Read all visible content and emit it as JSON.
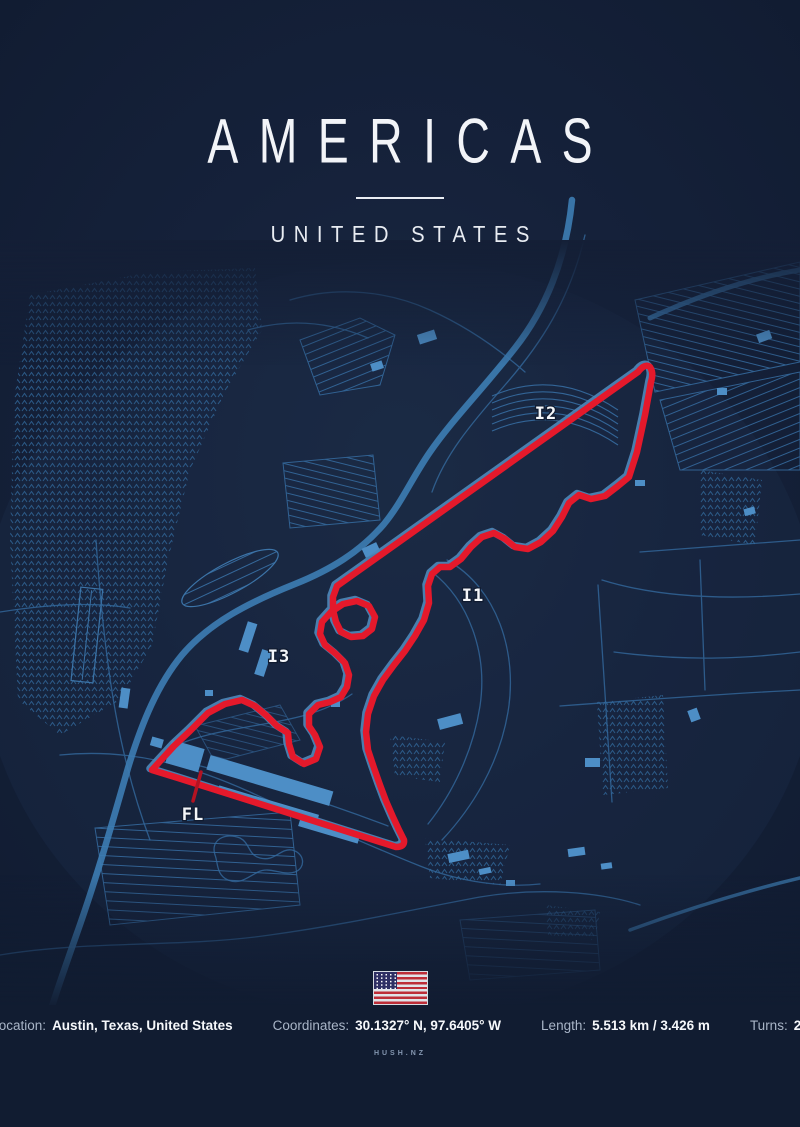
{
  "header": {
    "title": "AMERICAS",
    "subtitle": "UNITED STATES"
  },
  "map": {
    "name": "circuit-of-the-americas-track-map",
    "sector_labels": {
      "i1": "I1",
      "i2": "I2",
      "i3": "I3",
      "fl": "FL"
    }
  },
  "flag": {
    "country": "United States"
  },
  "info": {
    "location": {
      "label": "Location:",
      "value": "Austin, Texas, United States"
    },
    "coordinates": {
      "label": "Coordinates:",
      "value": "30.1327° N, 97.6405° W"
    },
    "length": {
      "label": "Length:",
      "value": "5.513 km / 3.426 m"
    },
    "turns": {
      "label": "Turns:",
      "value": "20"
    }
  },
  "brand": {
    "text": "HUSH.NZ"
  },
  "colors": {
    "background": "#15213a",
    "track_red": "#e4192b",
    "finish_line_red": "#b31322",
    "road_blue": "#346a9e",
    "highway_blue": "#3d7db4",
    "building_blue": "#4d8ec6",
    "text_white": "#f2f4f8",
    "muted_label": "#a9b5c7"
  }
}
